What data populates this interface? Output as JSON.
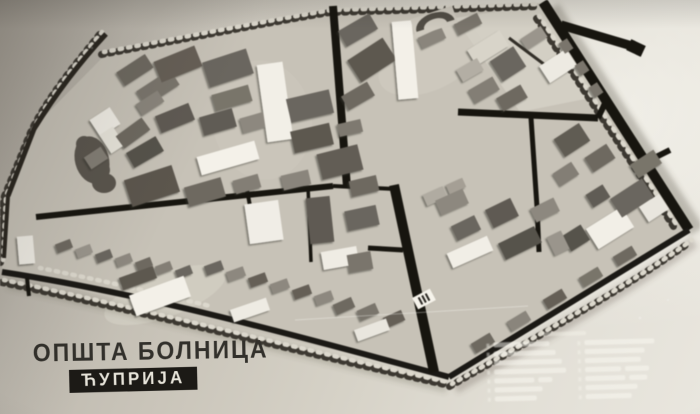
{
  "caption": {
    "line1": "ОПШТА БОЛНИЦА",
    "line2": "ЋУПРИЈА"
  },
  "legend": {
    "legible": false,
    "columns": 2,
    "rows_per_column": 7
  },
  "colors": {
    "paper": "#c9c4b9",
    "paper_bright": "#e9e6de",
    "road_ink": "#17150f",
    "building_dark": "#5d5850",
    "building_light": "#f2efe7",
    "caption_ink": "#32302b",
    "caption_box": "#1c1a16",
    "caption_box_text": "#e7e4da"
  }
}
